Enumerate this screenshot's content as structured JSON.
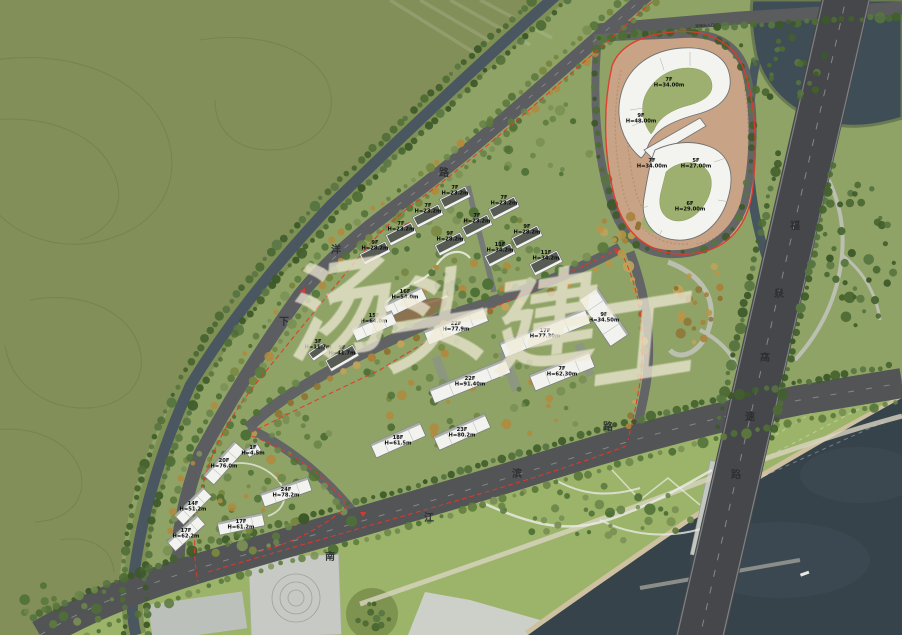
{
  "title": "滨江住区修建性详细规划总平面图",
  "watermark": {
    "text": "汤头建工",
    "color": "#f1ebd7",
    "chars": [
      {
        "c": "汤",
        "x": 335,
        "y": 320
      },
      {
        "c": "头",
        "x": 432,
        "y": 331
      },
      {
        "c": "建",
        "x": 540,
        "y": 333
      },
      {
        "c": "工",
        "x": 638,
        "y": 350
      }
    ]
  },
  "road_names": {
    "xiayang_road": {
      "name": "下洋路",
      "chars": [
        {
          "c": "下",
          "x": 284,
          "y": 325
        },
        {
          "c": "洋",
          "x": 336,
          "y": 253
        },
        {
          "c": "路",
          "x": 444,
          "y": 176
        }
      ]
    },
    "nanjiangbin_road": {
      "name": "南江滨路",
      "chars": [
        {
          "c": "南",
          "x": 330,
          "y": 560
        },
        {
          "c": "江",
          "x": 429,
          "y": 521
        },
        {
          "c": "滨",
          "x": 517,
          "y": 477
        },
        {
          "c": "路",
          "x": 608,
          "y": 430
        }
      ]
    },
    "fuquan_expressway": {
      "name": "福泉高速路",
      "chars": [
        {
          "c": "福",
          "x": 795,
          "y": 229
        },
        {
          "c": "泉",
          "x": 779,
          "y": 297
        },
        {
          "c": "高",
          "x": 765,
          "y": 361
        },
        {
          "c": "速",
          "x": 750,
          "y": 420
        },
        {
          "c": "路",
          "x": 736,
          "y": 478
        }
      ]
    }
  },
  "annotations": {
    "entrance_label": {
      "text": "道路出入口",
      "x": 705,
      "y": 27
    }
  },
  "parcels": {
    "northeast_mixed_use": {
      "buildings": [
        {
          "floors": "7F",
          "height": "H=34.00m",
          "x": 669,
          "y": 82
        },
        {
          "floors": "9F",
          "height": "H=48.00m",
          "x": 641,
          "y": 118
        },
        {
          "floors": "7F",
          "height": "H=34.00m",
          "x": 652,
          "y": 163
        },
        {
          "floors": "5F",
          "height": "H=27.00m",
          "x": 696,
          "y": 163
        },
        {
          "floors": "6F",
          "height": "H=29.00m",
          "x": 690,
          "y": 206
        }
      ]
    },
    "north_villas": {
      "buildings": [
        {
          "floors": "7F",
          "height": "H=23.2m",
          "x": 455,
          "y": 198,
          "angle": -27,
          "l": 29,
          "d": 12
        },
        {
          "floors": "7F",
          "height": "H=23.2m",
          "x": 428,
          "y": 216,
          "angle": -27,
          "l": 29,
          "d": 12
        },
        {
          "floors": "7F",
          "height": "H=23.2m",
          "x": 401,
          "y": 234,
          "angle": -27,
          "l": 29,
          "d": 12
        },
        {
          "floors": "9F",
          "height": "H=28.2m",
          "x": 375,
          "y": 253,
          "angle": -27,
          "l": 29,
          "d": 12
        },
        {
          "floors": "7F",
          "height": "H=23.2m",
          "x": 504,
          "y": 208,
          "angle": -27,
          "l": 29,
          "d": 12
        },
        {
          "floors": "7F",
          "height": "H=23.2m",
          "x": 477,
          "y": 226,
          "angle": -27,
          "l": 29,
          "d": 12
        },
        {
          "floors": "9F",
          "height": "H=28.2m",
          "x": 450,
          "y": 244,
          "angle": -27,
          "l": 29,
          "d": 12
        },
        {
          "floors": "9F",
          "height": "H=28.2m",
          "x": 527,
          "y": 237,
          "angle": -27,
          "l": 29,
          "d": 12
        },
        {
          "floors": "11F",
          "height": "H=34.2m",
          "x": 500,
          "y": 255,
          "angle": -27,
          "l": 29,
          "d": 12
        },
        {
          "floors": "11F",
          "height": "H=34.2m",
          "x": 546,
          "y": 263,
          "angle": -27,
          "l": 31,
          "d": 13
        },
        {
          "floors": "16F",
          "height": "H=54.0m",
          "x": 405,
          "y": 302,
          "angle": -26,
          "l": 42,
          "d": 14
        },
        {
          "floors": "15F",
          "height": "H=64.0m",
          "x": 374,
          "y": 326,
          "angle": -24,
          "l": 44,
          "d": 14
        },
        {
          "floors": "9F",
          "height": "H=41.7m",
          "x": 342,
          "y": 358,
          "angle": -30,
          "l": 32,
          "d": 13
        },
        {
          "floors": "3F",
          "height": "H=11.7m",
          "x": 318,
          "y": 352,
          "angle": -35,
          "l": 18,
          "d": 10
        }
      ]
    },
    "central_slabs": {
      "buildings": [
        {
          "floors": "22F",
          "height": "H=77.9m",
          "x": 456,
          "y": 326,
          "angle": -22,
          "l": 64,
          "d": 15
        },
        {
          "floors": "17F",
          "height": "H=77.30m",
          "x": 545,
          "y": 333,
          "angle": -22,
          "l": 92,
          "d": 16
        },
        {
          "floors": "9F",
          "height": "H=34.50m",
          "x": 604,
          "y": 317,
          "angle": 56,
          "l": 56,
          "d": 22
        },
        {
          "floors": "22F",
          "height": "H=91.40m",
          "x": 470,
          "y": 381,
          "angle": -22,
          "l": 82,
          "d": 15
        },
        {
          "floors": "7F",
          "height": "H=62.30m",
          "x": 562,
          "y": 371,
          "angle": -22,
          "l": 64,
          "d": 17
        },
        {
          "floors": "18F",
          "height": "H=61.5m",
          "x": 398,
          "y": 440,
          "angle": -24,
          "l": 54,
          "d": 15
        },
        {
          "floors": "23F",
          "height": "H=80.2m",
          "x": 462,
          "y": 432,
          "angle": -24,
          "l": 56,
          "d": 15
        }
      ]
    },
    "west_towers": {
      "buildings": [
        {
          "floors": "1F",
          "height": "H=4.5m",
          "x": 253,
          "y": 450,
          "angle": -30,
          "l": 14,
          "d": 9
        },
        {
          "floors": "20F",
          "height": "H=76.0m",
          "x": 224,
          "y": 463,
          "angle": -48,
          "l": 46,
          "d": 14
        },
        {
          "floors": "14F",
          "height": "H=51.2m",
          "x": 193,
          "y": 506,
          "angle": -45,
          "l": 40,
          "d": 13
        },
        {
          "floors": "24F",
          "height": "H=78.2m",
          "x": 286,
          "y": 492,
          "angle": -19,
          "l": 50,
          "d": 14
        },
        {
          "floors": "17F",
          "height": "H=61.2m",
          "x": 241,
          "y": 524,
          "angle": -12,
          "l": 46,
          "d": 13
        },
        {
          "floors": "17F",
          "height": "H=62.2m",
          "x": 186,
          "y": 533,
          "angle": -42,
          "l": 40,
          "d": 13
        }
      ]
    }
  },
  "palette": {
    "boundary_red": "#e2382c",
    "road_grey": "#55575a",
    "expressway_grey": "#45474a",
    "river_dark": "#37434b",
    "canal_water": "#4a5761",
    "hill_green": "#828f58",
    "park_green": "#9cb469",
    "building_white": "#f2f3ef",
    "terrace_tan": "#c9a385"
  }
}
